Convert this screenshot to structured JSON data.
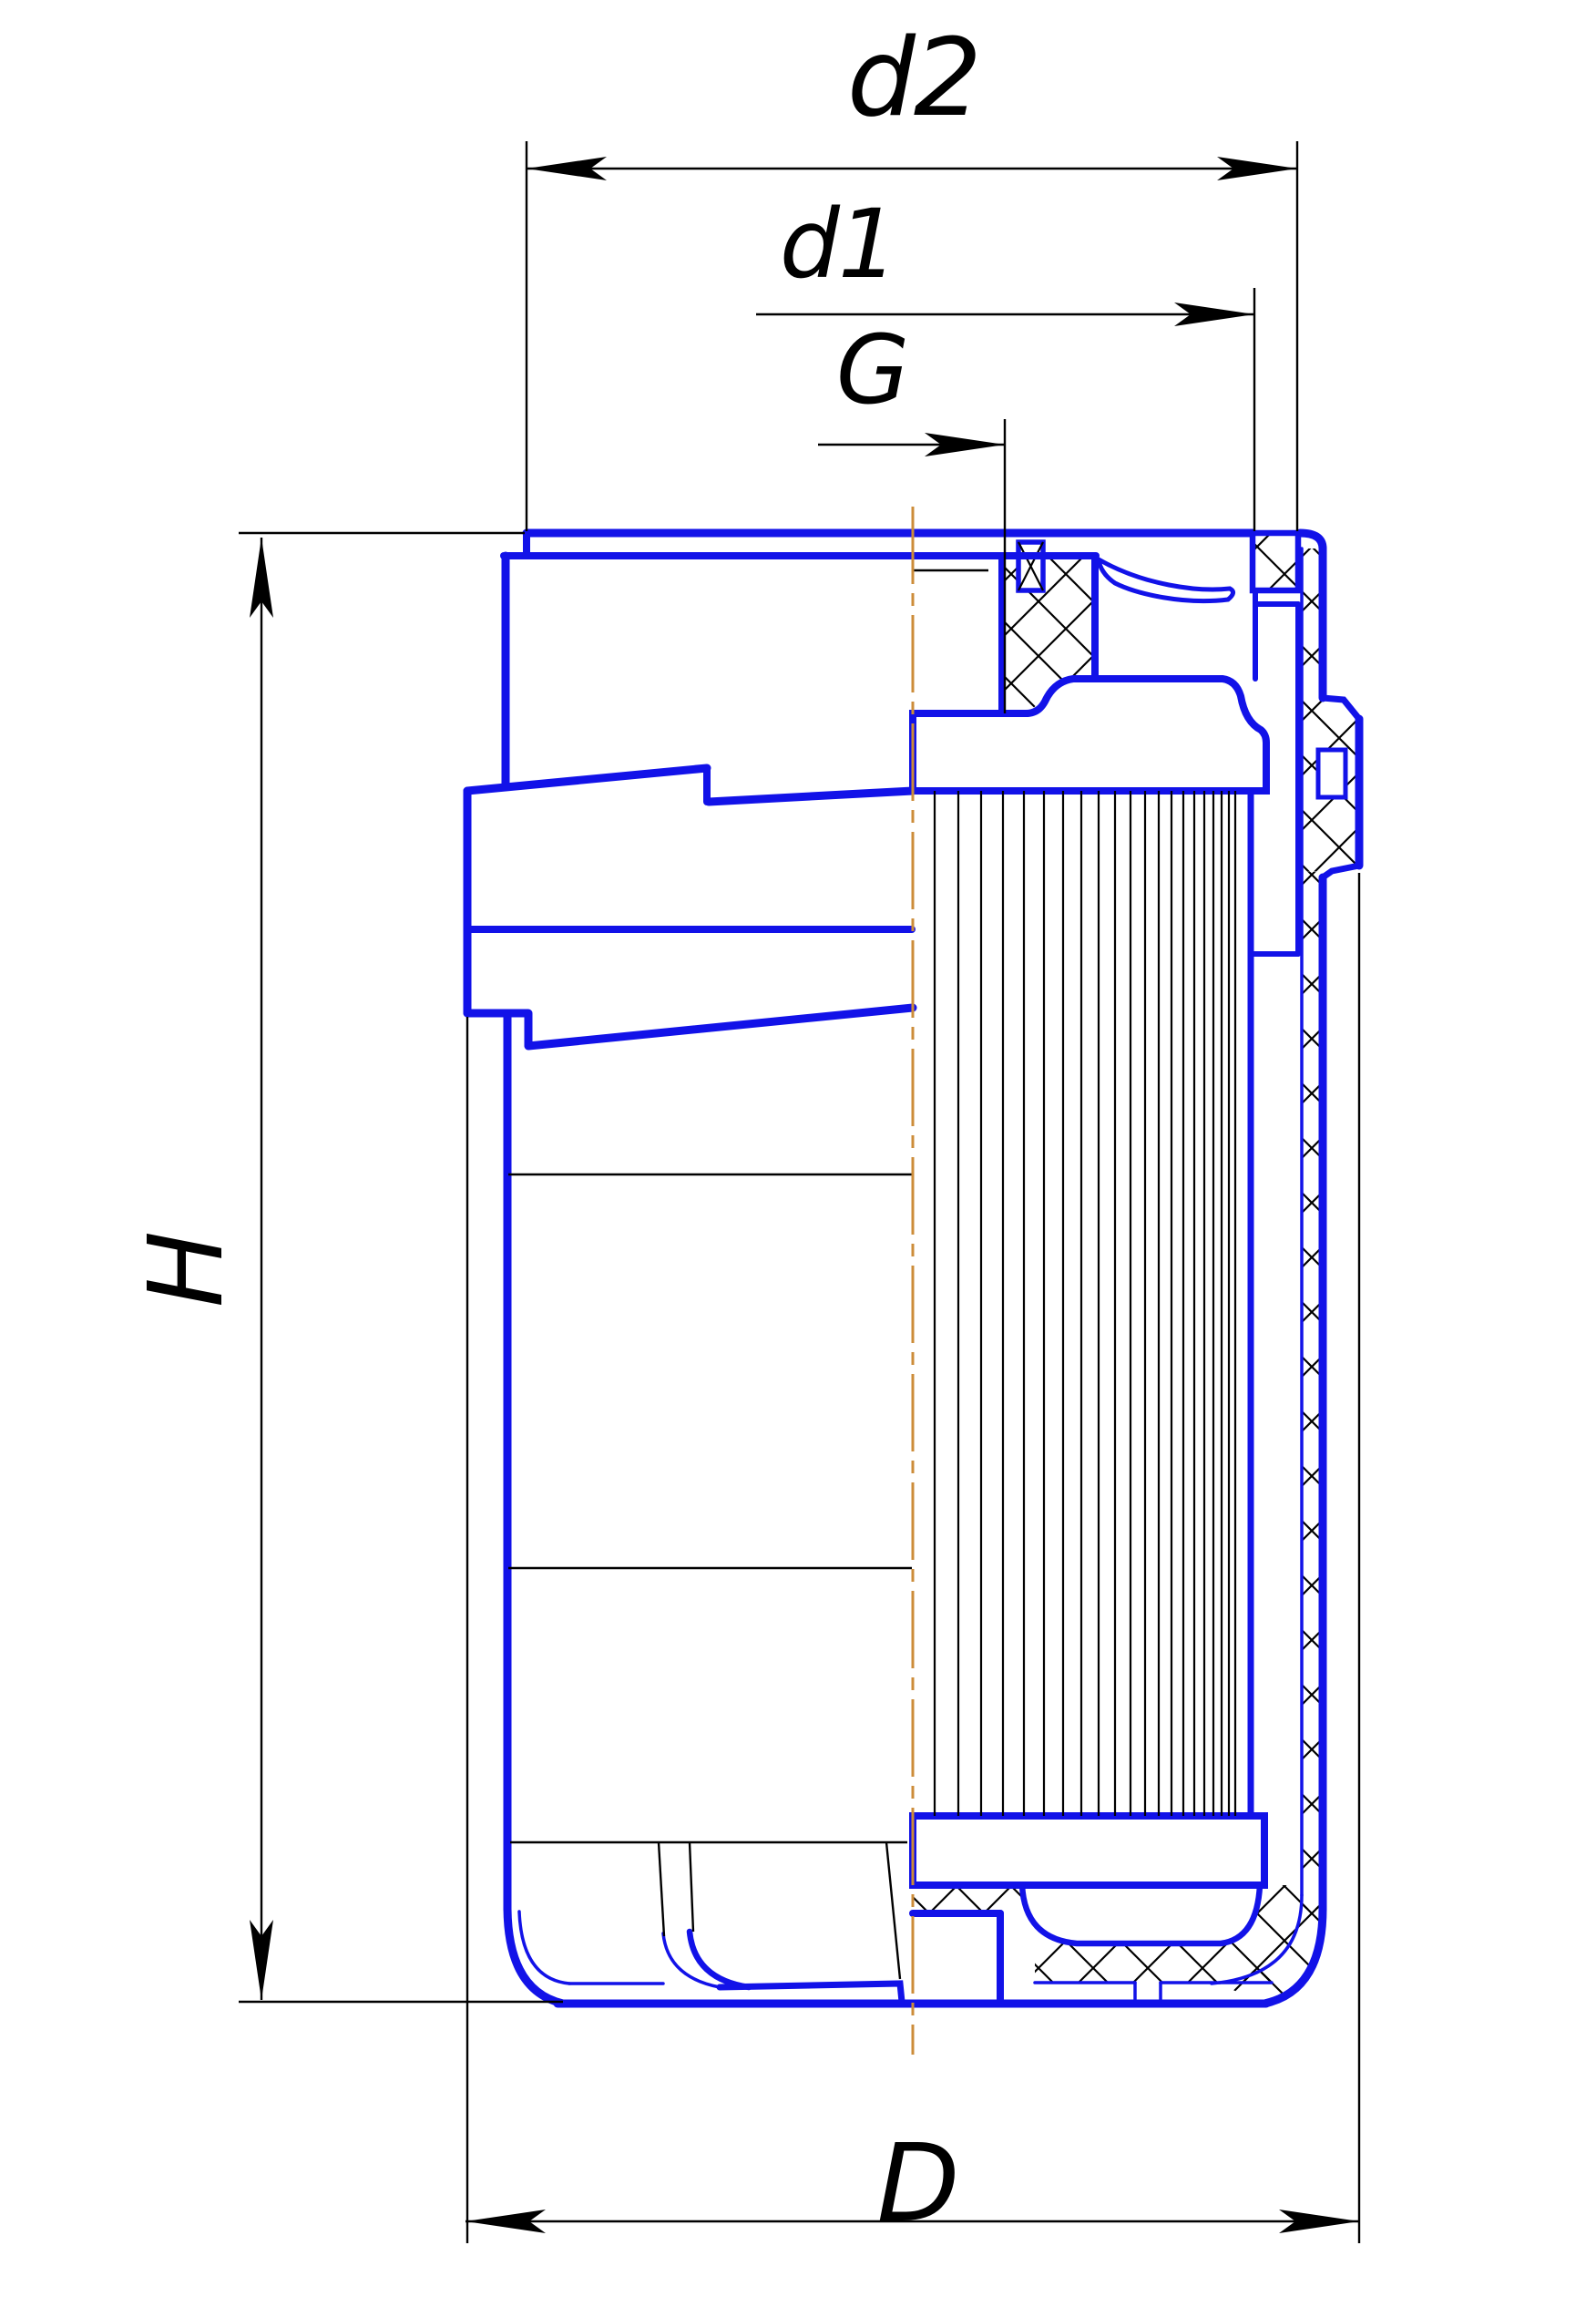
{
  "labels": {
    "d2": "d2",
    "d1": "d1",
    "G": "G",
    "H": "H",
    "D": "D"
  },
  "colors": {
    "part_outline": "#1212e8",
    "hatch_lines": "#000000",
    "dimension_lines": "#000000",
    "centerline": "#cc8c3a",
    "background": "#ffffff"
  }
}
